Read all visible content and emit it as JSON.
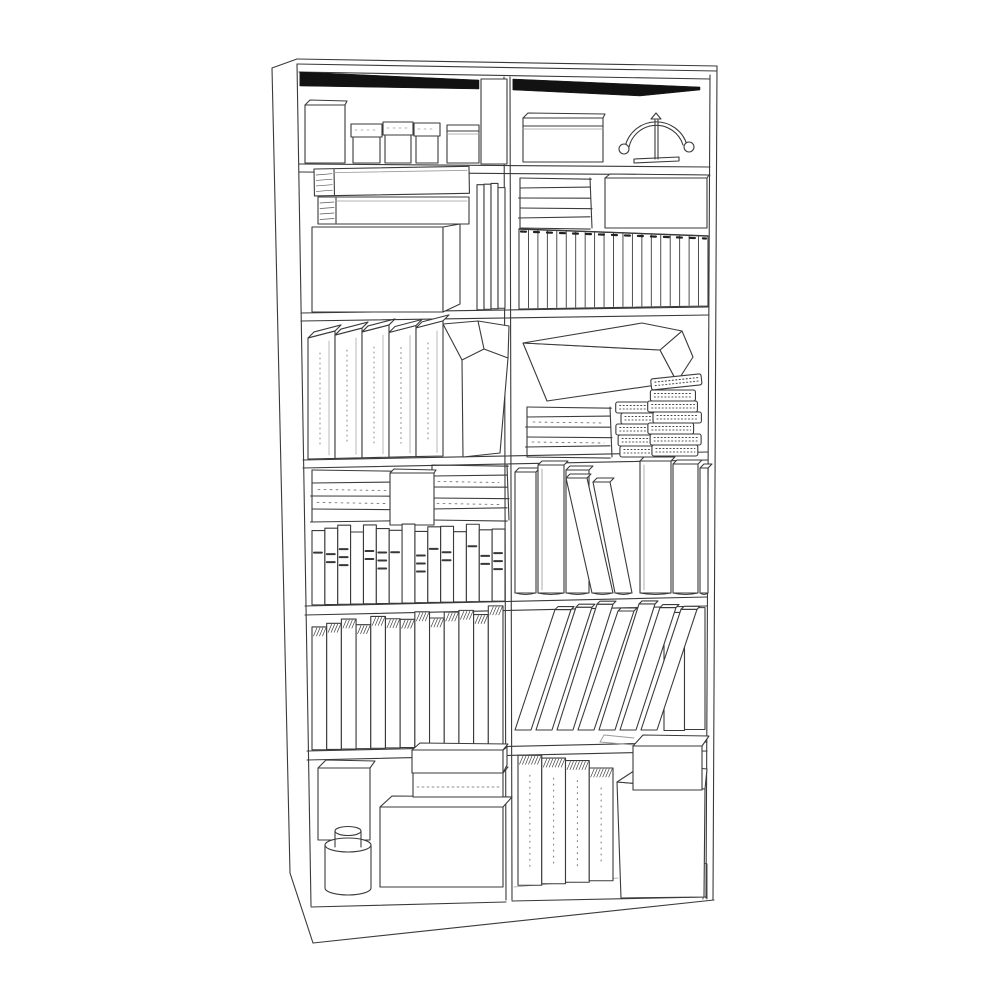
{
  "meta": {
    "subject": "monochrome line drawing of a tall two-column bookcase filled with books, boxes, binders, notebooks, a jar and an arc desk lamp",
    "style": {
      "background": "#ffffff",
      "line": "#3a3a3a",
      "light_line": "#9a9a9a",
      "accent_dark": "#2e2e2e",
      "shadow": "#121212",
      "stroke_width": 1.1
    },
    "columns": 2,
    "rows": 6
  },
  "frame": {
    "lines": [
      [
        272,
        68,
        297,
        59
      ],
      [
        297,
        59,
        717,
        66
      ],
      [
        297,
        64,
        717,
        71
      ],
      [
        272,
        68,
        290,
        873
      ],
      [
        290,
        873,
        313,
        943
      ],
      [
        313,
        943,
        714,
        900
      ],
      [
        717,
        66,
        713,
        900
      ],
      [
        297,
        64,
        311,
        906
      ],
      [
        710,
        75,
        706,
        898
      ],
      [
        504,
        77,
        506,
        900
      ],
      [
        510,
        77,
        512,
        900
      ],
      [
        299,
        72,
        710,
        79
      ],
      [
        299,
        164,
        710,
        167
      ],
      [
        299,
        172,
        710,
        175
      ],
      [
        301,
        313,
        709,
        307
      ],
      [
        301,
        321,
        709,
        315
      ],
      [
        303,
        460,
        708,
        452
      ],
      [
        303,
        468,
        708,
        460
      ],
      [
        305,
        606,
        707,
        597
      ],
      [
        305,
        615,
        707,
        606
      ],
      [
        307,
        751,
        707,
        742
      ],
      [
        307,
        760,
        707,
        751
      ],
      [
        311,
        907,
        506,
        902
      ],
      [
        512,
        901,
        707,
        897
      ]
    ],
    "light_lines": [
      [
        514,
        887,
        618,
        878
      ]
    ],
    "foot_path": "M703,866 L703,899 M707,864 L707,899 M703,866 Q705,862 707,864",
    "shadow_bands": [
      {
        "name": "top-shadow-left",
        "pts": [
          [
            300,
            72
          ],
          [
            479,
            80
          ],
          [
            479,
            89
          ],
          [
            300,
            86
          ]
        ]
      },
      {
        "name": "top-shadow-right",
        "pts": [
          [
            513,
            79
          ],
          [
            700,
            87
          ],
          [
            700,
            90
          ],
          [
            640,
            96
          ],
          [
            513,
            90
          ]
        ]
      }
    ]
  },
  "cells": [
    {
      "id": "shelf-1-left",
      "items": [
        {
          "type": "box",
          "name": "tall-storage-box",
          "x": 305,
          "y": 105,
          "w": 40,
          "h": 58,
          "top": [
            5,
            5
          ]
        },
        {
          "type": "box",
          "name": "small-lidded-box-1",
          "lidBox": true,
          "x": 351,
          "y": 124,
          "w": 31,
          "h": 39
        },
        {
          "type": "box",
          "name": "small-lidded-box-2",
          "lidBox": true,
          "x": 383,
          "y": 122,
          "w": 30,
          "h": 41
        },
        {
          "type": "box",
          "name": "small-lidded-box-3",
          "lidBox": true,
          "x": 414,
          "y": 123,
          "w": 26,
          "h": 40
        },
        {
          "type": "box",
          "name": "medium-box",
          "x": 447,
          "y": 125,
          "w": 32,
          "h": 38,
          "lid": 6
        },
        {
          "type": "box",
          "name": "tall-box-full-height",
          "x": 481,
          "y": 79,
          "w": 26,
          "h": 85
        }
      ]
    },
    {
      "id": "shelf-1-right",
      "items": [
        {
          "type": "box",
          "name": "lidded-gift-box",
          "x": 523,
          "y": 118,
          "w": 80,
          "h": 44,
          "lid": 8,
          "top": [
            5,
            5
          ]
        },
        {
          "type": "lamp",
          "name": "arc-desk-lamp",
          "cx": 656,
          "baseY": 163
        }
      ]
    },
    {
      "id": "shelf-2-left",
      "items": [
        {
          "type": "box",
          "name": "large-box",
          "x": 312,
          "y": 227,
          "w": 131,
          "h": 85,
          "side": 17
        },
        {
          "type": "hbook",
          "name": "stacked-book-lower",
          "x": 318,
          "y": 197,
          "w": 151,
          "h": 27,
          "pw": 18
        },
        {
          "type": "hbook",
          "name": "stacked-book-upper",
          "x": 314,
          "y": 169,
          "w": 155,
          "h": 27,
          "pw": 20,
          "rot": -1
        },
        {
          "type": "vbooks",
          "name": "thin-upright-books",
          "x": 477,
          "w": 28,
          "count": 4,
          "topL": 183,
          "topR": 186,
          "bottomL": 310,
          "bottomR": 308,
          "tj": 2
        }
      ]
    },
    {
      "id": "shelf-2-right",
      "items": [
        {
          "type": "hstack",
          "name": "flat-book-stack",
          "x": 520,
          "y": 178,
          "w": 70,
          "count": 5,
          "bottom": 228
        },
        {
          "type": "box",
          "name": "wide-box",
          "x": 605,
          "y": 178,
          "w": 102,
          "h": 50,
          "top": [
            5,
            4
          ]
        },
        {
          "type": "comics",
          "name": "magazine-row",
          "x": 519,
          "w": 189,
          "count": 20,
          "topL": 229,
          "topR": 236,
          "bottomL": 309,
          "bottomR": 306
        }
      ]
    },
    {
      "id": "shelf-3-left",
      "items": [
        {
          "type": "binders",
          "name": "ring-binders",
          "x": 308,
          "count": 5,
          "bw": 27,
          "topY": 330,
          "bottomL": 459,
          "bottomR": 456
        },
        {
          "type": "magfile",
          "name": "magazine-file"
        }
      ]
    },
    {
      "id": "shelf-3-right",
      "items": [
        {
          "type": "wedge",
          "name": "long-wedge-box"
        },
        {
          "type": "hstack",
          "name": "flat-box-stack",
          "x": 527,
          "y": 407,
          "w": 83,
          "count": 5,
          "bottom": 457,
          "dash": true
        },
        {
          "type": "notebooks",
          "name": "spiral-notebook-stack-left",
          "x": 618,
          "w": 44,
          "bottom": 457,
          "count": 5,
          "nh": 11
        },
        {
          "type": "notebooks",
          "name": "spiral-notebook-stack-right",
          "x": 650,
          "w": 48,
          "bottom": 456,
          "count": 7,
          "nh": 11,
          "tiltTop": true
        }
      ]
    },
    {
      "id": "shelf-4-left",
      "items": [
        {
          "type": "hstack",
          "name": "flat-box-stack-left",
          "x": 312,
          "y": 470,
          "w": 82,
          "count": 4,
          "bottom": 522,
          "dash": true
        },
        {
          "type": "hstack",
          "name": "flat-box-stack-right",
          "x": 432,
          "y": 465,
          "w": 75,
          "count": 5,
          "bottom": 520,
          "dash": true
        },
        {
          "type": "box",
          "name": "small-box-front",
          "x": 390,
          "y": 473,
          "w": 44,
          "h": 52,
          "top": [
            4,
            4
          ]
        },
        {
          "type": "media",
          "name": "slim-case-row",
          "x": 312,
          "w": 193,
          "count": 15,
          "top": 528,
          "bottomL": 605,
          "bottomR": 601
        }
      ]
    },
    {
      "id": "shelf-4-right",
      "items": [
        {
          "type": "books4r",
          "name": "tall-books",
          "bottom": 593,
          "books": [
            {
              "x": 515,
              "w": 21,
              "top": 472
            },
            {
              "x": 538,
              "w": 26,
              "top": 465,
              "pages": 1
            },
            {
              "x": 566,
              "w": 23,
              "top": 470
            },
            {
              "x": 640,
              "w": 31,
              "top": 461,
              "pages": 1
            },
            {
              "x": 673,
              "w": 25,
              "top": 464
            },
            {
              "x": 700,
              "w": 8,
              "top": 468
            },
            {
              "x": 592,
              "w": 21,
              "top": 478,
              "lean": -26
            },
            {
              "x": 615,
              "w": 17,
              "top": 482,
              "lean": -22
            }
          ]
        }
      ]
    },
    {
      "id": "shelf-5-left",
      "items": [
        {
          "type": "vbooks",
          "name": "paperback-row",
          "x": 312,
          "w": 191,
          "count": 13,
          "topL": 625,
          "topR": 609,
          "bottomL": 750,
          "bottomR": 745,
          "tj": 4,
          "hatch": true
        }
      ]
    },
    {
      "id": "shelf-5-right",
      "items": [
        {
          "type": "vbooks",
          "name": "upright-books",
          "x": 664,
          "w": 41,
          "count": 2,
          "topL": 612,
          "topR": 606,
          "bottomL": 731,
          "bottomR": 729,
          "tj": 3
        },
        {
          "type": "leaning",
          "name": "leaning-books",
          "x": 515,
          "count": 7,
          "bw": 16,
          "step": 21,
          "lean": 40,
          "top": 607,
          "bottom": 730
        }
      ]
    },
    {
      "id": "shelf-6-left",
      "items": [
        {
          "type": "box",
          "name": "tall-box",
          "x": 318,
          "y": 768,
          "w": 52,
          "h": 72,
          "top": [
            8,
            8
          ]
        },
        {
          "type": "cylinder",
          "name": "round-jar",
          "cx": 348,
          "r": 23,
          "topY": 845,
          "bottomY": 888,
          "capR": 13,
          "capTopY": 831,
          "capBottomY": 847
        },
        {
          "type": "box",
          "name": "large-box",
          "x": 380,
          "y": 807,
          "w": 123,
          "h": 80,
          "top": [
            12,
            11
          ]
        },
        {
          "type": "box",
          "name": "flat-box-lower",
          "x": 413,
          "y": 773,
          "w": 90,
          "h": 24,
          "top": [
            8,
            7
          ],
          "dashY": 14
        },
        {
          "type": "box",
          "name": "flat-box-upper",
          "x": 412,
          "y": 750,
          "w": 91,
          "h": 23,
          "top": [
            8,
            7
          ],
          "side": 4
        }
      ]
    },
    {
      "id": "shelf-6-right",
      "items": [
        {
          "type": "vbooks",
          "name": "large-books",
          "x": 518,
          "w": 95,
          "count": 4,
          "topL": 752,
          "topR": 768,
          "bottomL": 886,
          "bottomR": 880,
          "tj": 2,
          "hatch": true,
          "dotted": true
        },
        {
          "type": "platform",
          "name": "riser-platform"
        },
        {
          "type": "box",
          "name": "small-box-on-platform",
          "x": 633,
          "y": 746,
          "w": 69,
          "h": 44,
          "top": [
            10,
            11
          ]
        }
      ]
    }
  ]
}
